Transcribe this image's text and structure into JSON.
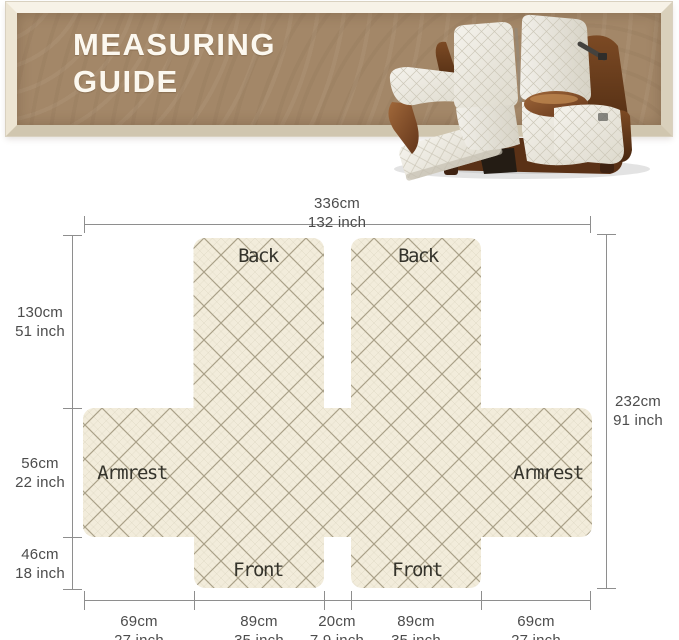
{
  "banner": {
    "title_line1": "MEASURING",
    "title_line2": "GUIDE"
  },
  "panels": {
    "back_left": "Back",
    "back_right": "Back",
    "armrest_left": "Armrest",
    "armrest_right": "Armrest",
    "front_left": "Front",
    "front_right": "Front"
  },
  "dimensions": {
    "top": {
      "cm": "336cm",
      "inch": "132 inch"
    },
    "right": {
      "cm": "232cm",
      "inch": "91 inch"
    },
    "left": [
      {
        "cm": "130cm",
        "inch": "51 inch"
      },
      {
        "cm": "56cm",
        "inch": "22 inch"
      },
      {
        "cm": "46cm",
        "inch": "18 inch"
      }
    ],
    "bottom": [
      {
        "cm": "69cm",
        "inch": "27 inch"
      },
      {
        "cm": "89cm",
        "inch": "35 inch"
      },
      {
        "cm": "20cm",
        "inch": "7.9 inch"
      },
      {
        "cm": "89cm",
        "inch": "35 inch"
      },
      {
        "cm": "69cm",
        "inch": "27 inch"
      }
    ]
  },
  "colors": {
    "banner_brown": "#a38768",
    "frame_cream": "#ece4d4",
    "quilt_background": "#f2ecdb",
    "quilt_line": "#b3aa8f",
    "dimension_line": "#8e8e8e",
    "label_text": "#34332b",
    "leather_brown": "#7c4a24",
    "cover_cream": "#efede4"
  }
}
